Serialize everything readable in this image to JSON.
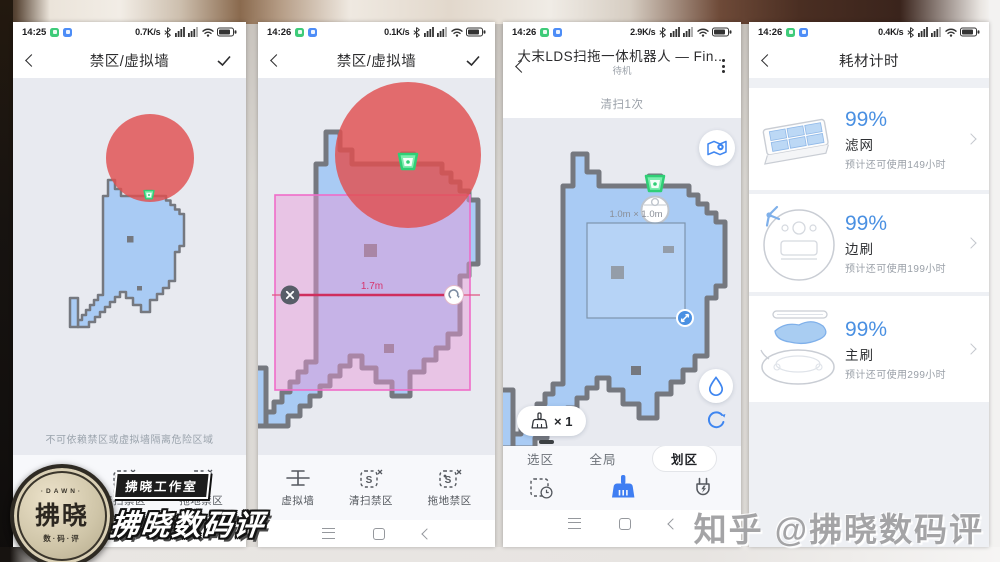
{
  "colors": {
    "accent": "#3f86f0",
    "percent_blue": "#4a90e2",
    "danger_red": "#e04f4f",
    "map_fill": "#a9cbf4",
    "map_wall": "#75787f",
    "dock_green": "#2fcf76",
    "nogo_pink": "#ef6cc8",
    "wall_line_red": "#cf2e5e"
  },
  "status": {
    "s1": {
      "time": "14:25",
      "speed": "0.7K/s"
    },
    "s2": {
      "time": "14:26",
      "speed": "0.1K/s"
    },
    "s3": {
      "time": "14:26",
      "speed": "2.9K/s"
    },
    "s4": {
      "time": "14:26",
      "speed": "0.4K/s"
    }
  },
  "zones": {
    "title": "禁区/虚拟墙",
    "hint": "不可依赖禁区或虚拟墙隔离危险区域",
    "wall_length": "1.7m",
    "toolbar": [
      {
        "label": "虚拟墙"
      },
      {
        "label": "清扫禁区"
      },
      {
        "label": "拖地禁区"
      }
    ]
  },
  "robot": {
    "title": "大末LDS扫拖一体机器人 — Fin...",
    "state": "待机",
    "clean_count": "清扫1次",
    "zone_size": "1.0m × 1.0m",
    "repeat": "× 1",
    "tabs": [
      {
        "label": "选区"
      },
      {
        "label": "全局"
      },
      {
        "label": "划区"
      }
    ]
  },
  "consumables": {
    "title": "耗材计时",
    "items": [
      {
        "percent": "99%",
        "name": "滤网",
        "estimate": "预计还可使用149小时"
      },
      {
        "percent": "99%",
        "name": "边刷",
        "estimate": "预计还可使用199小时"
      },
      {
        "percent": "99%",
        "name": "主刷",
        "estimate": "预计还可使用299小时"
      }
    ]
  },
  "watermarks": {
    "zhihu": "知乎 @拂晓数码评",
    "stamp_studio": "拂晓工作室",
    "stamp_name": "拂晓数码评",
    "seal_top": "·DAWN·",
    "seal_text": "拂晓",
    "seal_bottom": "数·码·评"
  }
}
